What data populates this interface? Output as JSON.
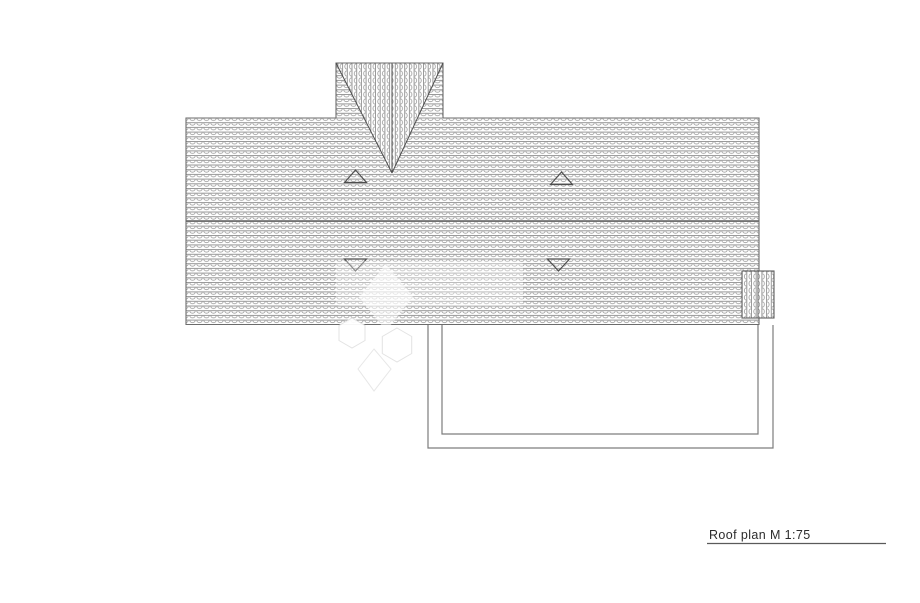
{
  "page": {
    "background_color": "#ffffff"
  },
  "drawing": {
    "type": "architectural-roof-plan",
    "caption": {
      "text": "Roof plan M 1:75",
      "color": "#2c2c2c",
      "underline_color": "#5a5a5a"
    },
    "colors": {
      "roof_outline": "#6b6b6b",
      "ridge_line": "#606060",
      "tile_stroke": "#8e8e8e",
      "tile_arc": "#9a9a9a",
      "valley_line": "#4e4e4e",
      "vent_marker": "#4e4e4e",
      "chimney_outline": "#5f5f5f",
      "terrace_outline": "#7d7d7d",
      "watermark": "#ffffff",
      "watermark_edge": "#e2e2e2"
    }
  }
}
